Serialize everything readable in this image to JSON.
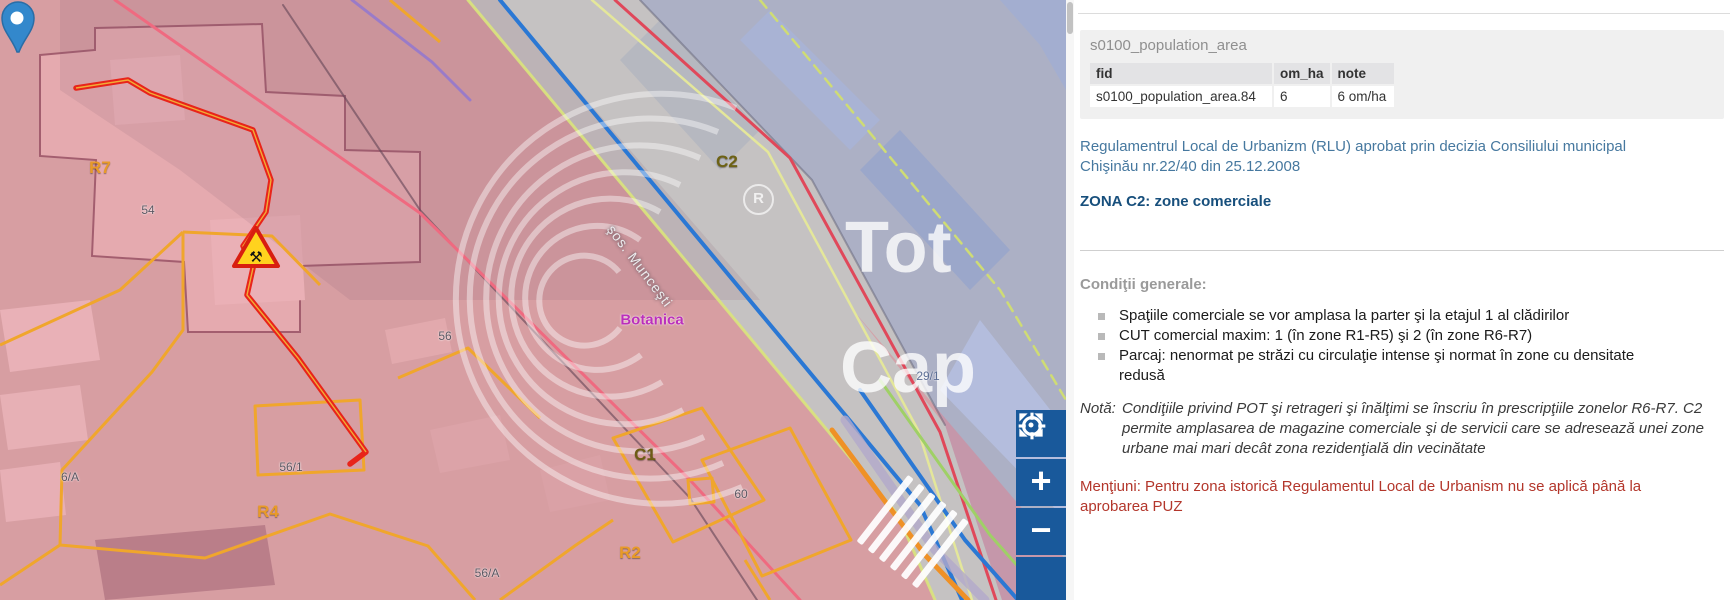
{
  "panel": {
    "feature_info": {
      "title": "s0100_population_area",
      "table": {
        "columns": [
          "fid",
          "om_ha",
          "note"
        ],
        "rows": [
          [
            "s0100_population_area.84",
            "6",
            "6 om/ha"
          ]
        ]
      }
    },
    "regulation_intro": "Regulamentrul Local de Urbanizm (RLU) aprobat prin decizia Consiliului municipal Chişinău nr.22/40 din 25.12.2008",
    "zone_title": "ZONA C2: zone comerciale",
    "conditions_heading": "Condiţii generale:",
    "conditions": [
      "Spaţiile comerciale se vor amplasa la parter şi la etajul 1 al clădirilor",
      "CUT comercial maxim: 1 (în zone R1-R5) şi 2 (în zone R6-R7)",
      "Parcaj: nenormat pe străzi cu circulaţie intense şi normat în zone cu densitate redusă"
    ],
    "note_label": "Notă:",
    "note_text": "Condiţiile privind POT şi retrageri şi înălţimi se înscriu în prescripţiile zonelor R6-R7. C2 permite amplasarea de magazine comerciale şi de servicii care se adresează unei zone urbane mai mari decât zona rezidenţială din vecinătate",
    "mentions_text": "Menţiuni: Pentru zona istorică Regulamentul Local de Urbanism nu se aplică până la aprobarea PUZ"
  },
  "map": {
    "labels": [
      {
        "text": "R7",
        "color": "#e89a28"
      },
      {
        "text": "54",
        "color": "#5a5560"
      },
      {
        "text": "6/A",
        "color": "#5a5560"
      },
      {
        "text": "R4",
        "color": "#e89a28"
      },
      {
        "text": "56/1",
        "color": "#5a5560"
      },
      {
        "text": "56",
        "color": "#5a5560"
      },
      {
        "text": "56/A",
        "color": "#5a5560"
      },
      {
        "text": "C1",
        "color": "#6d5c14"
      },
      {
        "text": "60",
        "color": "#5a5560"
      },
      {
        "text": "R2",
        "color": "#e89a28"
      },
      {
        "text": "C2",
        "color": "#6d6214"
      },
      {
        "text": "29/1",
        "color": "#5b6d94"
      },
      {
        "text": "Botanica",
        "color": "#bb2fbb"
      },
      {
        "text": "şos. Munceşti",
        "color": "#ececee"
      }
    ],
    "watermark": {
      "line1": "Tot",
      "line2": "Cap",
      "registered": "R"
    },
    "controls": [
      {
        "name": "locate",
        "icon": "target"
      },
      {
        "name": "zoom-in",
        "label": "+"
      },
      {
        "name": "zoom-out",
        "label": "−"
      },
      {
        "name": "fullscreen",
        "icon": "expand-arrows"
      }
    ],
    "colors": {
      "residential_overlay": "#e57a8a",
      "commercial_overlay": "#8d9bd0",
      "route_line": "#e8241a",
      "parcel_line": "#f0a62c",
      "road_edge_line": "#2b78d4",
      "control_button": "#19599b",
      "pin": "#3388cc"
    }
  }
}
